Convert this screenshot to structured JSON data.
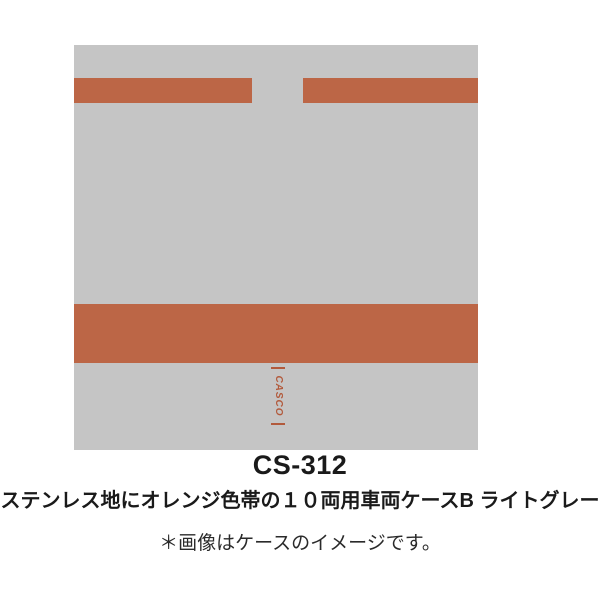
{
  "product": {
    "model": "CS-312",
    "description": "ステンレス地にオレンジ色帯の１０両用車両ケースB ライトグレー",
    "note": "＊画像はケースのイメージです。"
  },
  "image": {
    "logo_text": "CASCO",
    "case_description": "light gray train case with orange stripes"
  },
  "colors": {
    "background": "#ffffff",
    "case_gray": "#c5c5c5",
    "band_orange": "#bc6646",
    "logo_orange": "#b25a3c",
    "text_dark": "#1a1a1a",
    "text_note": "#2a2a2a"
  }
}
